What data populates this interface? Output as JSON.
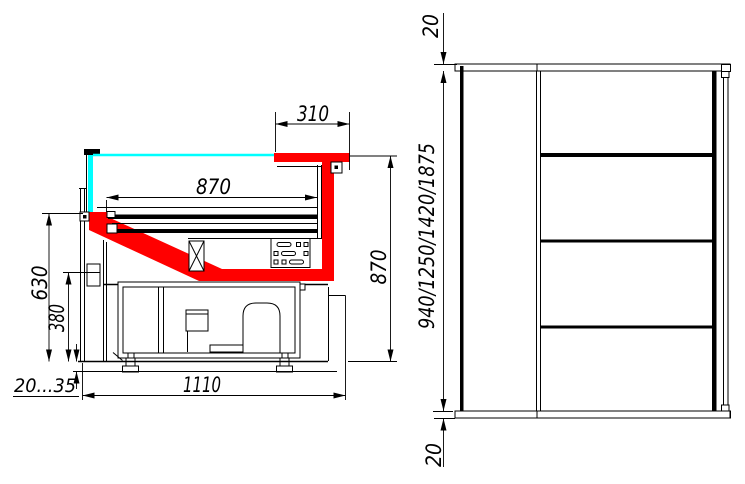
{
  "drawing": {
    "colors": {
      "accent": "#ff0000",
      "glass": "#00ffff",
      "line": "#000000",
      "background": "#ffffff"
    },
    "section_view": {
      "dims": {
        "canopy_depth": "310",
        "deck_length": "870",
        "counter_height": "630",
        "base_height": "380",
        "foot_adjust": "20...35",
        "overall_depth": "1110",
        "rear_height": "870"
      }
    },
    "side_view": {
      "dims": {
        "top_panel": "20",
        "height_options": "940/1250/1420/1875",
        "bottom_panel": "20"
      }
    }
  }
}
